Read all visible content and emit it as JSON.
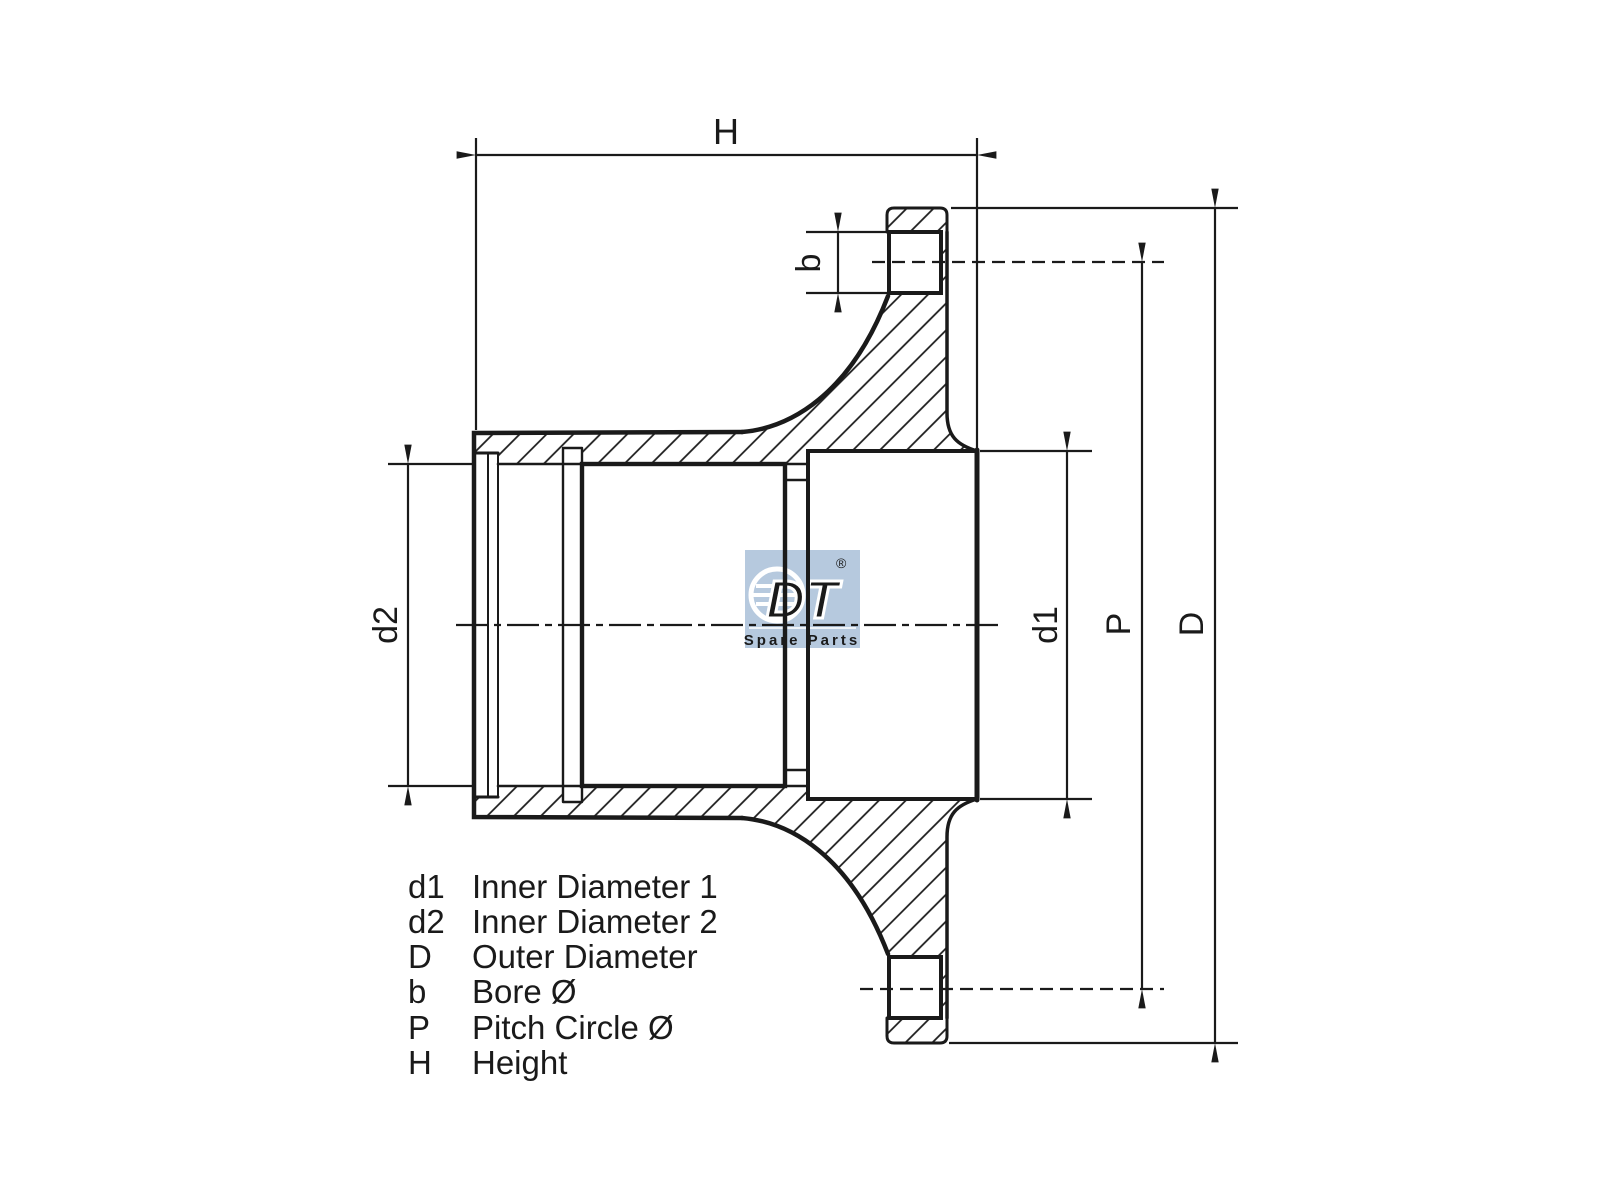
{
  "dimensions": {
    "h": {
      "label": "H"
    },
    "b": {
      "label": "b"
    },
    "d1": {
      "label": "d1"
    },
    "d2": {
      "label": "d2"
    },
    "p": {
      "label": "P"
    },
    "d": {
      "label": "D"
    }
  },
  "legend": {
    "rows": [
      {
        "symbol": "d1",
        "description": "Inner Diameter 1"
      },
      {
        "symbol": "d2",
        "description": "Inner Diameter 2"
      },
      {
        "symbol": "D",
        "description": "Outer Diameter"
      },
      {
        "symbol": "b",
        "description": "Bore Ø"
      },
      {
        "symbol": "P",
        "description": "Pitch Circle Ø"
      },
      {
        "symbol": "H",
        "description": "Height"
      }
    ]
  },
  "logo": {
    "brand": "DT",
    "registered": "®",
    "subtitle": "Spare Parts",
    "color": "#b6c9de"
  },
  "colors": {
    "line": "#1a1a1a",
    "background": "#ffffff"
  }
}
